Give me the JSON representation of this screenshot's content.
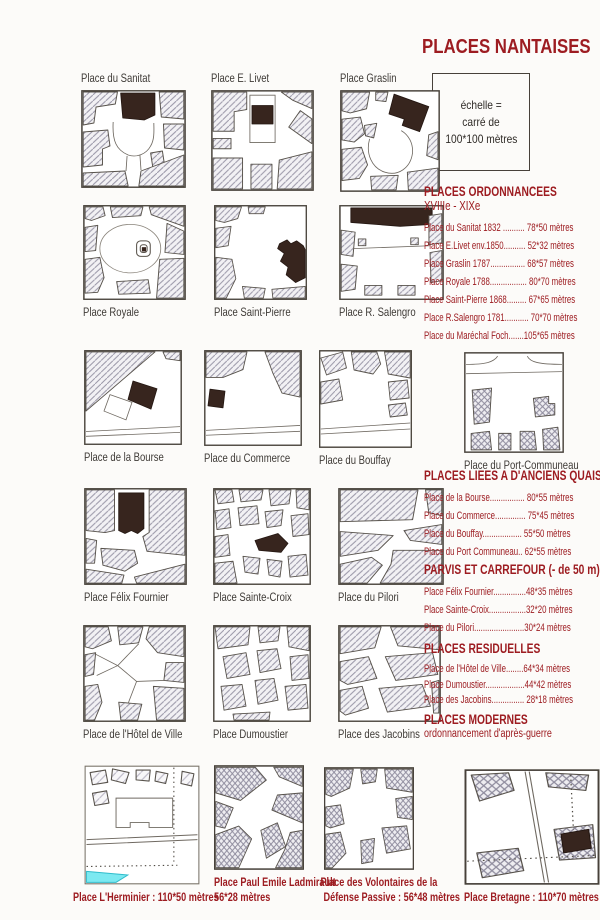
{
  "page": {
    "title": "PLACES NANTAISES"
  },
  "scale_box": {
    "lines": [
      "échelle =",
      "carré  de",
      "100*100 mètres"
    ]
  },
  "tiles": {
    "sanitat": {
      "label": "Place du Sanitat"
    },
    "livet": {
      "label": "Place E. Livet"
    },
    "graslin": {
      "label": "Place Graslin"
    },
    "royale": {
      "label": "Place Royale"
    },
    "stpierre": {
      "label": "Place Saint-Pierre"
    },
    "salengro": {
      "label": "Place R. Salengro"
    },
    "bourse": {
      "label": "Place de la Bourse"
    },
    "commerce": {
      "label": "Place du Commerce"
    },
    "bouffay": {
      "label": "Place du Bouffay"
    },
    "portcommuneau": {
      "label": "Place du Port-Communeau"
    },
    "fournier": {
      "label": "Place Félix Fournier"
    },
    "stecroix": {
      "label": "Place Sainte-Croix"
    },
    "pilori": {
      "label": "Place du Pilori"
    },
    "hoteldeville": {
      "label": "Place de l'Hôtel de Ville"
    },
    "dumoustier": {
      "label": "Place Dumoustier"
    },
    "jacobins": {
      "label": "Place des Jacobins"
    },
    "herminier": {
      "label": "Place L'Herminier : 110*50 mètres"
    },
    "ladmirault": {
      "lines": [
        "Place Paul Emile Ladmirault",
        "56*28 mètres"
      ]
    },
    "volontaires": {
      "lines": [
        "Place des Volontaires de la",
        "Défense Passive : 56*48 mètres"
      ]
    },
    "bretagne": {
      "label": "Place Bretagne : 110*70 mètres"
    }
  },
  "sections": [
    {
      "heading": "PLACES ORDONNANCEES",
      "subheading": "XVIIIe - XIXe",
      "items": [
        {
          "text": "Place du Sanitat 1832 .......... 78*50 mètres"
        },
        {
          "text": "Place E.Livet env.1850.......... 52*32 mètres"
        },
        {
          "text": "Place Graslin 1787................ 68*57 mètres"
        },
        {
          "text": "Place Royale 1788................. 80*70 mètres"
        },
        {
          "text": "Place Saint-Pierre 1868......... 67*65 mètres"
        },
        {
          "text": "Place R.Salengro 1781........... 70*70 mètres"
        },
        {
          "text": "Place du Maréchal Foch.......105*65 mètres"
        }
      ]
    },
    {
      "heading": "PLACES LIEES A D'ANCIENS QUAIS",
      "items": [
        {
          "text": "Place de la Bourse................ 80*55 mètres"
        },
        {
          "text": "Place du Commerce.............. 75*45 mètres"
        },
        {
          "text": "Place du Bouffay.................. 55*50 mètres"
        },
        {
          "text": "Place du Port Communeau.. 62*55 mètres"
        }
      ]
    },
    {
      "heading": "PARVIS ET CARREFOUR (- de 50 m)",
      "items": [
        {
          "text": "Place Félix Fournier...............48*35 mètres"
        },
        {
          "text": "Place Sainte-Croix.................32*20 mètres"
        },
        {
          "text": "Place du Pilori.......................30*24 mètres"
        }
      ]
    },
    {
      "heading": "PLACES RESIDUELLES",
      "items": [
        {
          "text": "Place de l'Hôtel de Ville........64*34 mètres"
        },
        {
          "text": "Place Dumoustier..................44*42 mètres"
        },
        {
          "text": "Place des Jacobins............... 28*18 mètres"
        }
      ]
    },
    {
      "heading": "PLACES MODERNES",
      "subheading": "ordonnancement d'après-guerre",
      "items": []
    }
  ],
  "colors": {
    "accent_red": "#9d1c21",
    "building_dark": "#37251e",
    "water_cyan": "#7ce9f1"
  }
}
